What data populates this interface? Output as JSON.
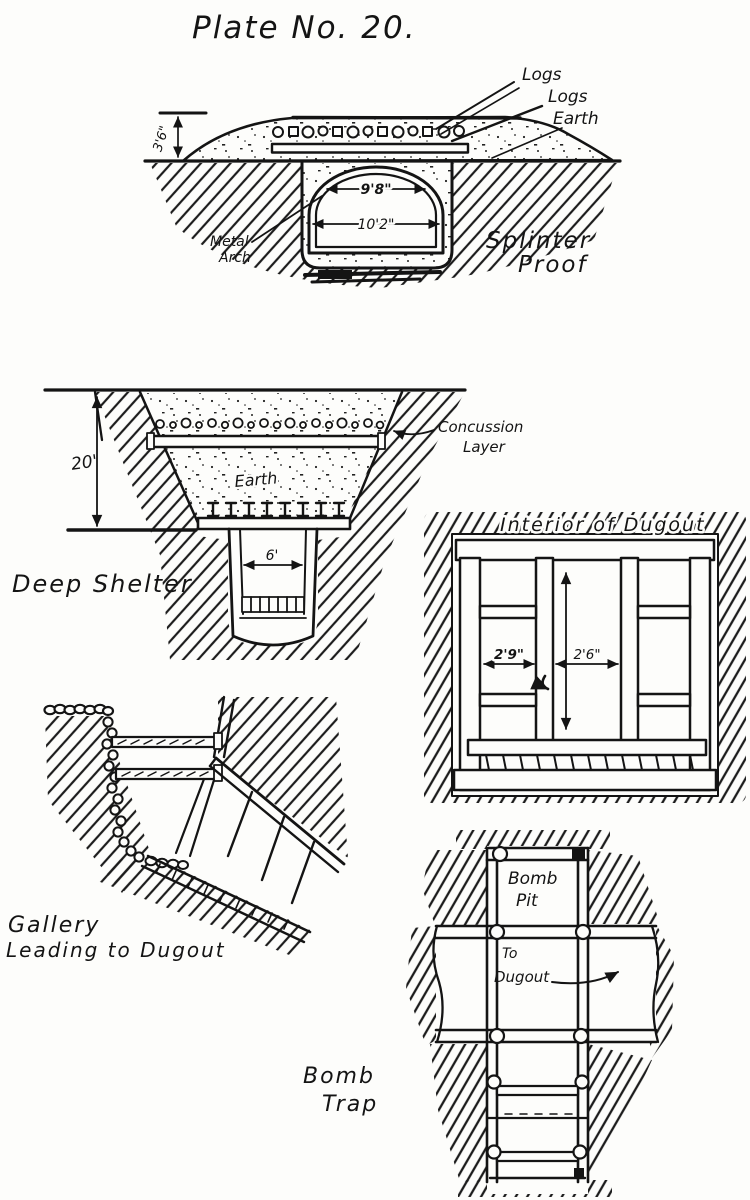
{
  "page": {
    "title": "Plate No. 20.",
    "paper_color": "#fdfdfb",
    "ink_color": "#141414"
  },
  "splinter_proof": {
    "caption_line1": "Splinter",
    "caption_line2": "Proof",
    "label_logs_1": "Logs",
    "label_logs_2": "Logs",
    "label_earth": "Earth",
    "label_metal_1": "Metal",
    "label_metal_2": "Arch",
    "dim_mound_height": "3'6\"",
    "dim_arch_span": "9'8\"",
    "dim_floor_span": "10'2\""
  },
  "deep_shelter": {
    "caption": "Deep Shelter",
    "label_concussion_1": "Concussion",
    "label_concussion_2": "Layer",
    "label_earth": "Earth",
    "dim_depth": "20'",
    "dim_shaft_width": "6'"
  },
  "interior_dugout": {
    "caption": "Interior of Dugout",
    "dim_left_bay": "2'9\"",
    "dim_center_bay": "2'6\""
  },
  "gallery": {
    "caption_line1": "Gallery",
    "caption_line2": "Leading to Dugout"
  },
  "bomb_trap": {
    "caption_line1": "Bomb",
    "caption_line2": "Trap",
    "label_pit_1": "Bomb",
    "label_pit_2": "Pit",
    "label_to_dugout_1": "To",
    "label_to_dugout_2": "Dugout"
  }
}
